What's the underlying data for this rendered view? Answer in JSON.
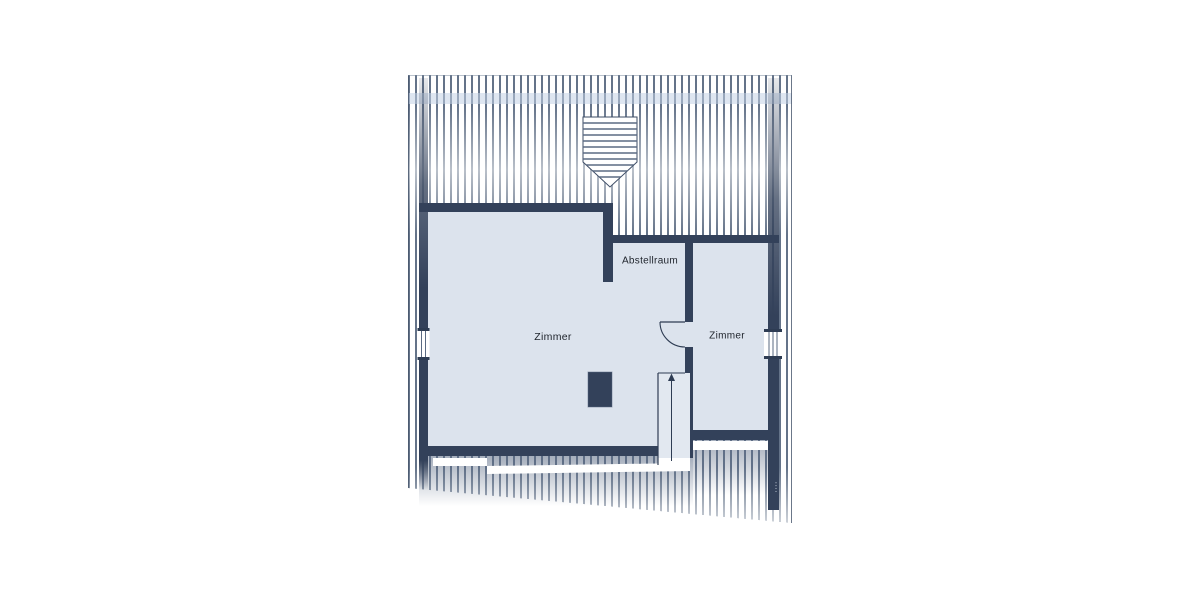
{
  "floorplan": {
    "rooms": [
      {
        "label": "Zimmer"
      },
      {
        "label": "Abstellraum"
      },
      {
        "label": "Zimmer"
      }
    ],
    "stairs": {
      "direction": "up"
    },
    "watermark_text": "••••",
    "colors": {
      "wall": "#33415a",
      "floor": "#dce3ed",
      "hatch_line": "#53637c",
      "roof_band": "#c3d2e6",
      "page_background": "#ffffff"
    }
  }
}
